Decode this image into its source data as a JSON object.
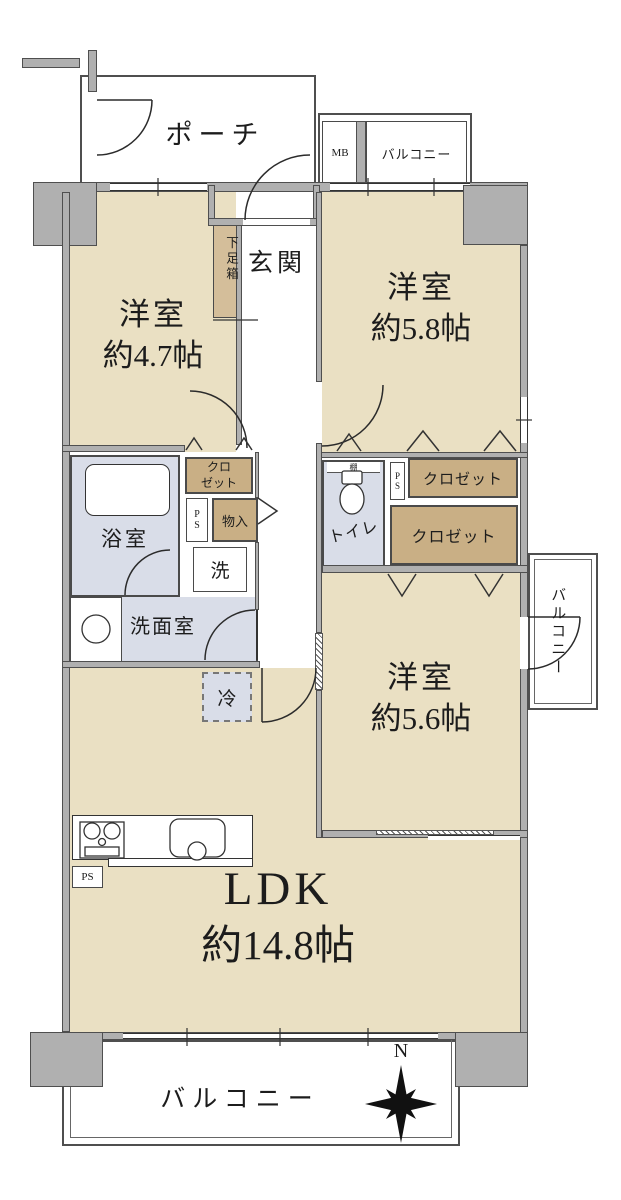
{
  "plan": {
    "porch": {
      "label": "ポーチ"
    },
    "meter_box": {
      "label": "MB"
    },
    "balcony_north": {
      "label": "バルコニー"
    },
    "entrance": {
      "label": "玄関"
    },
    "shoe_box": {
      "label": "下足箱"
    },
    "bedroom_nw": {
      "label": "洋室",
      "size": "約4.7帖"
    },
    "bedroom_ne": {
      "label": "洋室",
      "size": "約5.8帖"
    },
    "bedroom_se": {
      "label": "洋室",
      "size": "約5.6帖"
    },
    "ldk": {
      "label": "LDK",
      "size": "約14.8帖"
    },
    "closet_nw": {
      "line1": "クロ",
      "line2": "ゼット"
    },
    "storage": {
      "label": "物入"
    },
    "pipe_space_left": {
      "label": "PS"
    },
    "pipe_space_right": {
      "label": "PS"
    },
    "pipe_space_kitchen": {
      "label": "PS"
    },
    "bathroom": {
      "label": "浴室"
    },
    "washer": {
      "label": "洗"
    },
    "washroom": {
      "label": "洗面室"
    },
    "toilet": {
      "label": "トイレ",
      "shelf": "棚"
    },
    "closet_e1": {
      "label": "クロゼット"
    },
    "closet_e2": {
      "label": "クロゼット"
    },
    "balcony_east": {
      "label": "バルコニー"
    },
    "refrigerator": {
      "label": "冷"
    },
    "balcony_south": {
      "label": "バルコニー"
    },
    "compass": {
      "north": "N"
    }
  },
  "colors": {
    "room_fill": "#eae0c3",
    "closet_fill": "#c9af85",
    "shoebox_fill": "#d4be9a",
    "wet_area_fill": "#d9dde8",
    "wall_fill": "#b0b0b0",
    "wall_line": "#4f4f4f",
    "line": "#2b2b2b",
    "text": "#1c1c1c",
    "background": "#ffffff"
  }
}
